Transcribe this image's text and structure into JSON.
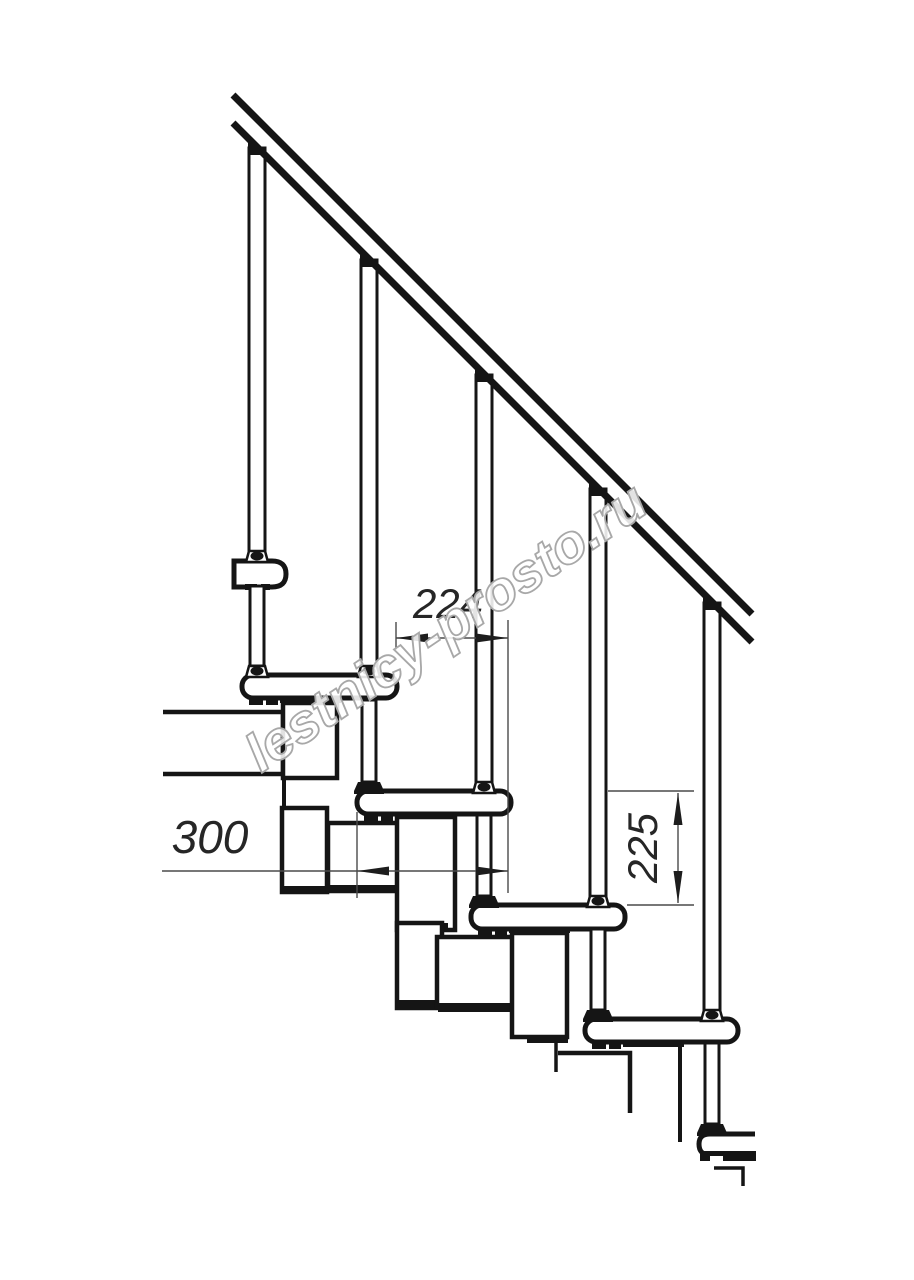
{
  "page": {
    "background": "#ffffff"
  },
  "drawing": {
    "kind": "modular staircase side-view technical drawing",
    "line_color": "#151515",
    "dimension_color": "#4a4a4a",
    "dimensions": [
      {
        "id": "step-run",
        "label": "224",
        "orientation": "horizontal"
      },
      {
        "id": "tread-depth",
        "label": "300",
        "orientation": "horizontal"
      },
      {
        "id": "step-rise",
        "label": "225",
        "orientation": "vertical"
      }
    ],
    "watermark": {
      "text": "lestnicy-prosto.ru",
      "fill": "#ffffff",
      "outline": "#a8a8a8"
    }
  }
}
